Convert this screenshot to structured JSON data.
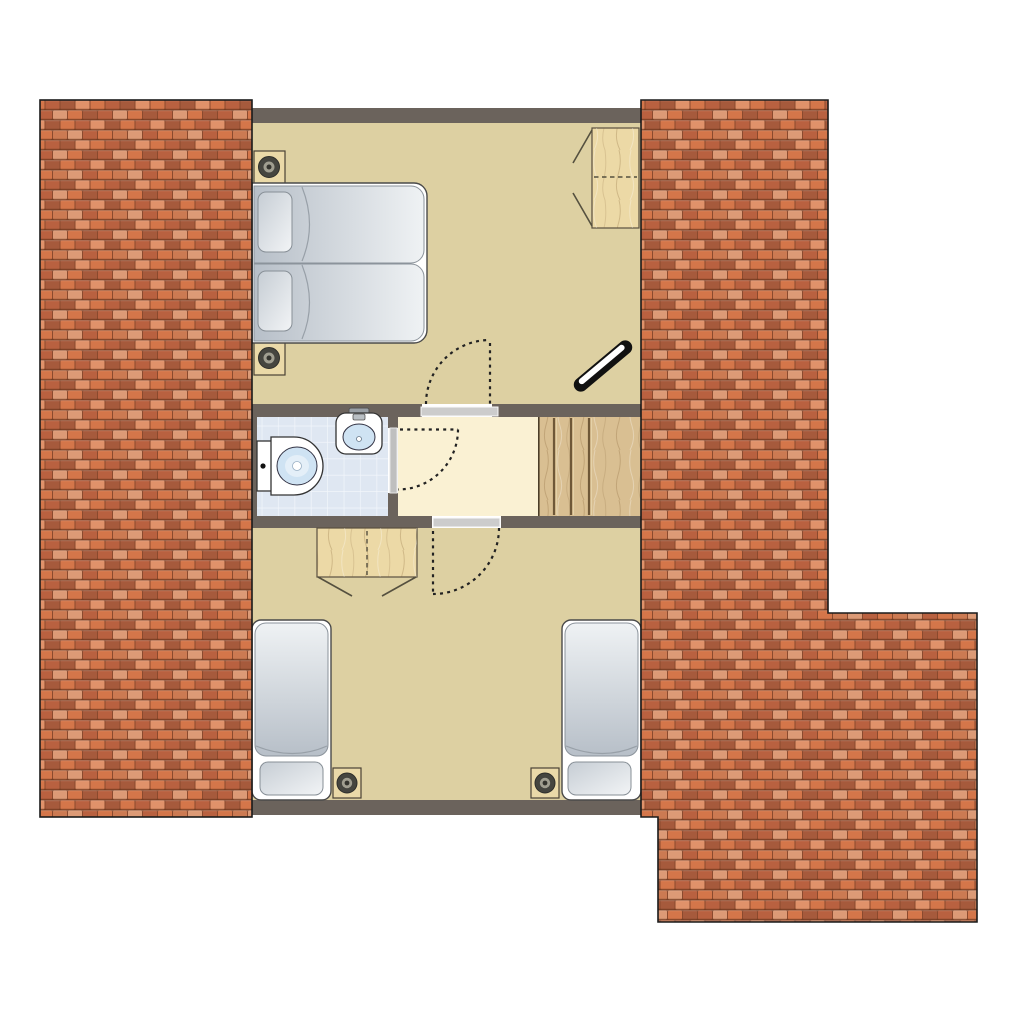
{
  "colors": {
    "background": "#ffffff",
    "wall": "#6b635c",
    "floor_tan": "#ddd0a2",
    "floor_cream": "#faf1d3",
    "bath_tile": "#dfe7f2",
    "bath_tile_line": "#f2f6fb",
    "stair_wood": "#d9bf92",
    "stair_line": "#6f5838",
    "furn_wood": "#ecd9a6",
    "nightstand": "#ead9a8",
    "outline": "#222222",
    "threshold": "#cccccc",
    "door_leaf": "#bfbfbf",
    "ceramic": "#cfe3f3",
    "metal": "#9aa0a6",
    "frame_stroke": "#4a4a4a",
    "mattress_light": "#eff2f4",
    "mattress_dark": "#b7bfc8",
    "pillow_light": "#f2f4f6",
    "pillow_dark": "#c6cdd4",
    "roof_base": "#8a4a2e",
    "roof1": "#d4764a",
    "roof2": "#b96140",
    "roof3": "#e0926a",
    "roof4": "#a65a3c",
    "roof5": "#cc7a52",
    "roof6": "#dc9a76"
  },
  "floorplan": {
    "areas": [
      {
        "id": "roof-left",
        "kind": "roof-tiles"
      },
      {
        "id": "roof-right",
        "kind": "roof-tiles"
      },
      {
        "id": "bedroom-top",
        "kind": "room"
      },
      {
        "id": "bathroom",
        "kind": "room"
      },
      {
        "id": "hallway",
        "kind": "room"
      },
      {
        "id": "staircase",
        "kind": "stairs"
      },
      {
        "id": "bedroom-bottom",
        "kind": "room"
      }
    ],
    "furniture": [
      {
        "room": "bedroom-top",
        "items": [
          "double-bed",
          "nightstand-lamp",
          "nightstand-lamp",
          "wardrobe-open",
          "roof-window",
          "door-swing"
        ]
      },
      {
        "room": "bathroom",
        "items": [
          "toilet",
          "washbasin",
          "door-leaf",
          "door-swing"
        ]
      },
      {
        "room": "staircase",
        "items": [
          "stair-treads"
        ]
      },
      {
        "room": "bedroom-bottom",
        "items": [
          "single-bed",
          "single-bed",
          "wardrobe-open",
          "nightstand-lamp",
          "nightstand-lamp",
          "door-swing"
        ]
      }
    ]
  }
}
